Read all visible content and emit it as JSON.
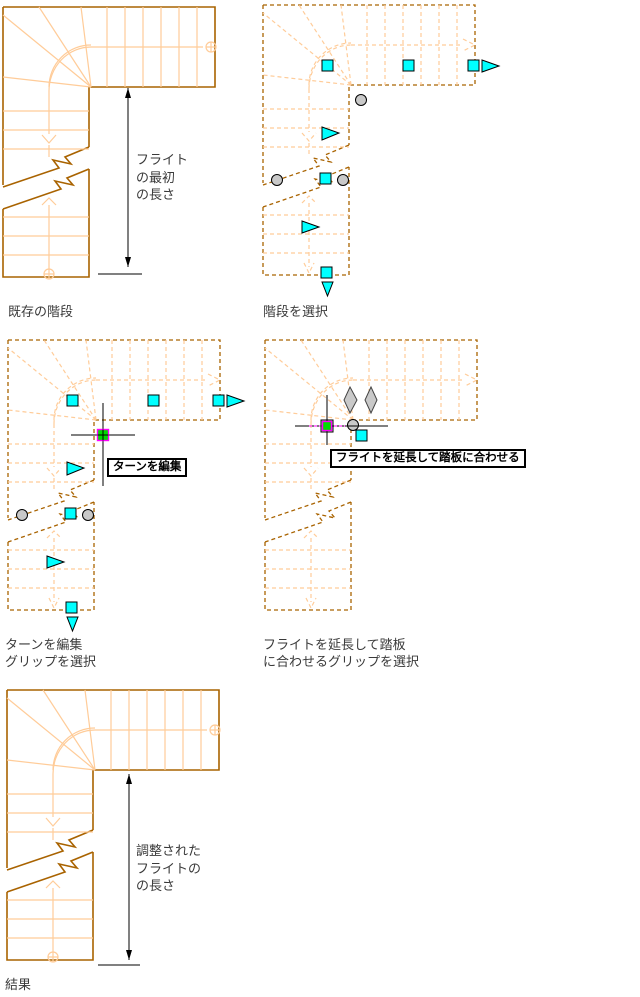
{
  "colors": {
    "stair_outline": "#A96300",
    "stair_tread": "#FFCC99",
    "grip_cyan": "#00FFFF",
    "grip_gray": "#C9C9C9",
    "hot_grip_fill": "#00DC00",
    "hot_grip_border": "#FF00FF",
    "dimension_black": "#000000"
  },
  "icons": {
    "square-grip": "cyan-square",
    "arrow-grip": "cyan-triangle",
    "circle-grip": "gray-circle",
    "diamond-grip": "gray-vertical-diamond",
    "hot-grip": "green-square-magenta-border",
    "crosshair-cursor": "black-cross",
    "flow-circle": "light-circle",
    "flow-arrow": "light-arrow"
  },
  "figures": [
    {
      "caption": "既存の階段",
      "dimension_label_lines": [
        "フライト",
        "の最初",
        "の長さ"
      ]
    },
    {
      "caption": "階段を選択"
    },
    {
      "caption_lines": [
        "ターンを編集",
        "グリップを選択"
      ],
      "tooltip": "ターンを編集"
    },
    {
      "caption_lines": [
        "フライトを延長して踏板",
        "に合わせるグリップを選択"
      ],
      "tooltip": "フライトを延長して踏板に合わせる"
    },
    {
      "caption": "結果",
      "dimension_label_lines": [
        "調整された",
        "フライトの",
        "の長さ"
      ]
    }
  ]
}
